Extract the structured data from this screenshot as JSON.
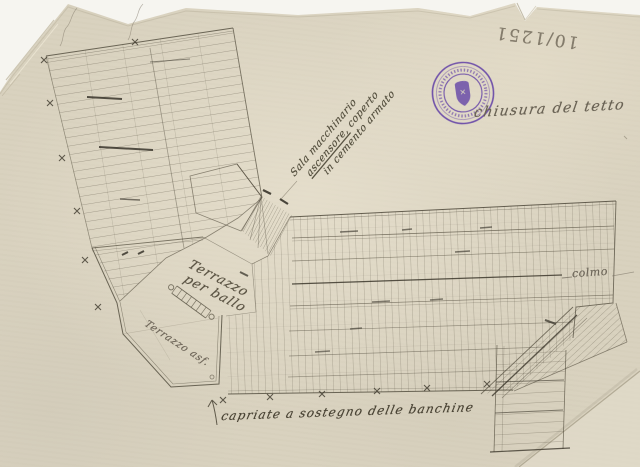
{
  "document": {
    "kind": "scanned hand-drawn roof plan on aged paper",
    "paper_color": "#d9d2bf",
    "ink_color": "#4a4435",
    "pencil_color": "#7b7363",
    "stamp": {
      "shape": "circular with central shield",
      "color": "#5936a4"
    }
  },
  "annotations": {
    "catalog_number": "10/1251",
    "roof_note": "chiusura del tetto",
    "machinery_note": {
      "line1": "Sala macchinario",
      "line2_underlined": "ascensore,",
      "line2_rest": "coperto",
      "line3": "in cemento armato"
    },
    "terrace_ballroom": {
      "line1": "Terrazzo",
      "line2": "per ballo"
    },
    "terrace_asphalt": "Terrazzo asf.",
    "ridge_label": "colmo",
    "trusses_note": "capriate a sostegno delle banchine"
  }
}
